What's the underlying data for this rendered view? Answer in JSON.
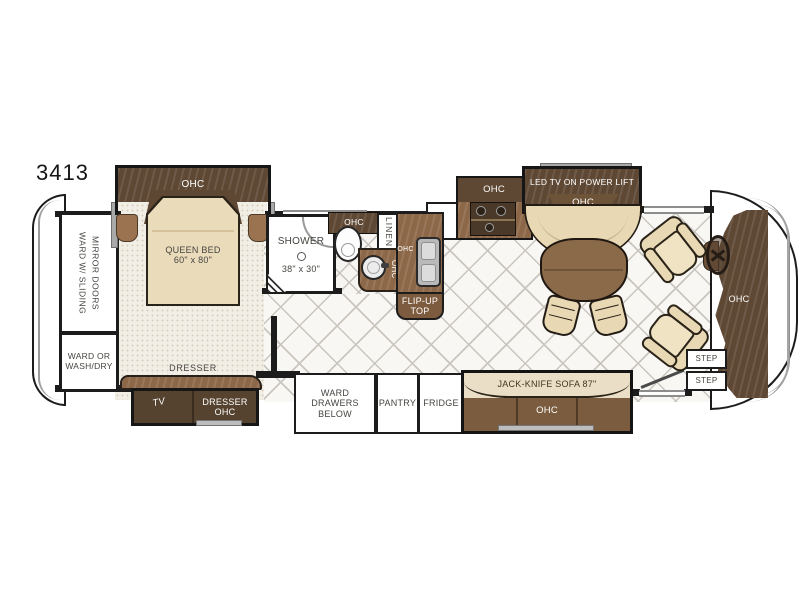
{
  "model": "3413",
  "colors": {
    "wall": "#1c1c1c",
    "wood_dark": "#5e4733",
    "wood_mid": "#8d6848",
    "upholstery_cream": "#e9d8b4",
    "sofa_seat": "#7b5c3e",
    "carpet": "#f1eee6",
    "tile_line": "#c9c5bf",
    "fixture_gray": "#bdbdbd"
  },
  "bedroom": {
    "ohc": "OHC",
    "queen_bed_line1": "QUEEN BED",
    "queen_bed_line2": "60\" x 80\"",
    "dresser": "DRESSER",
    "tv": "TV",
    "dresser_ohc_line1": "DRESSER",
    "dresser_ohc_line2": "OHC",
    "ward_sliding_line1": "WARD W/ SLIDING",
    "ward_sliding_line2": "MIRROR DOORS",
    "ward_washdry_line1": "WARD OR",
    "ward_washdry_line2": "WASH/DRY"
  },
  "bath": {
    "shower_line1": "SHOWER",
    "shower_line2": "38\" x 30\"",
    "toilet_ohc": "OHC",
    "linen": "LINEN",
    "vanity_ohc": "OHC"
  },
  "kitchen": {
    "sink_ohc": "OHC",
    "flip_up_line1": "FLIP-UP",
    "flip_up_line2": "TOP",
    "galley_ohc": "OHC",
    "ward_drawers_line1": "WARD",
    "ward_drawers_line2": "DRAWERS",
    "ward_drawers_line3": "BELOW",
    "pantry": "PANTRY",
    "fridge": "FRIDGE"
  },
  "living": {
    "led_tv": "LED TV ON POWER LIFT",
    "tv_ohc": "OHC",
    "sofa": "JACK-KNIFE SOFA 87\"",
    "sofa_ohc": "OHC",
    "dash_ohc": "OHC",
    "step_upper": "STEP",
    "step_lower": "STEP"
  }
}
